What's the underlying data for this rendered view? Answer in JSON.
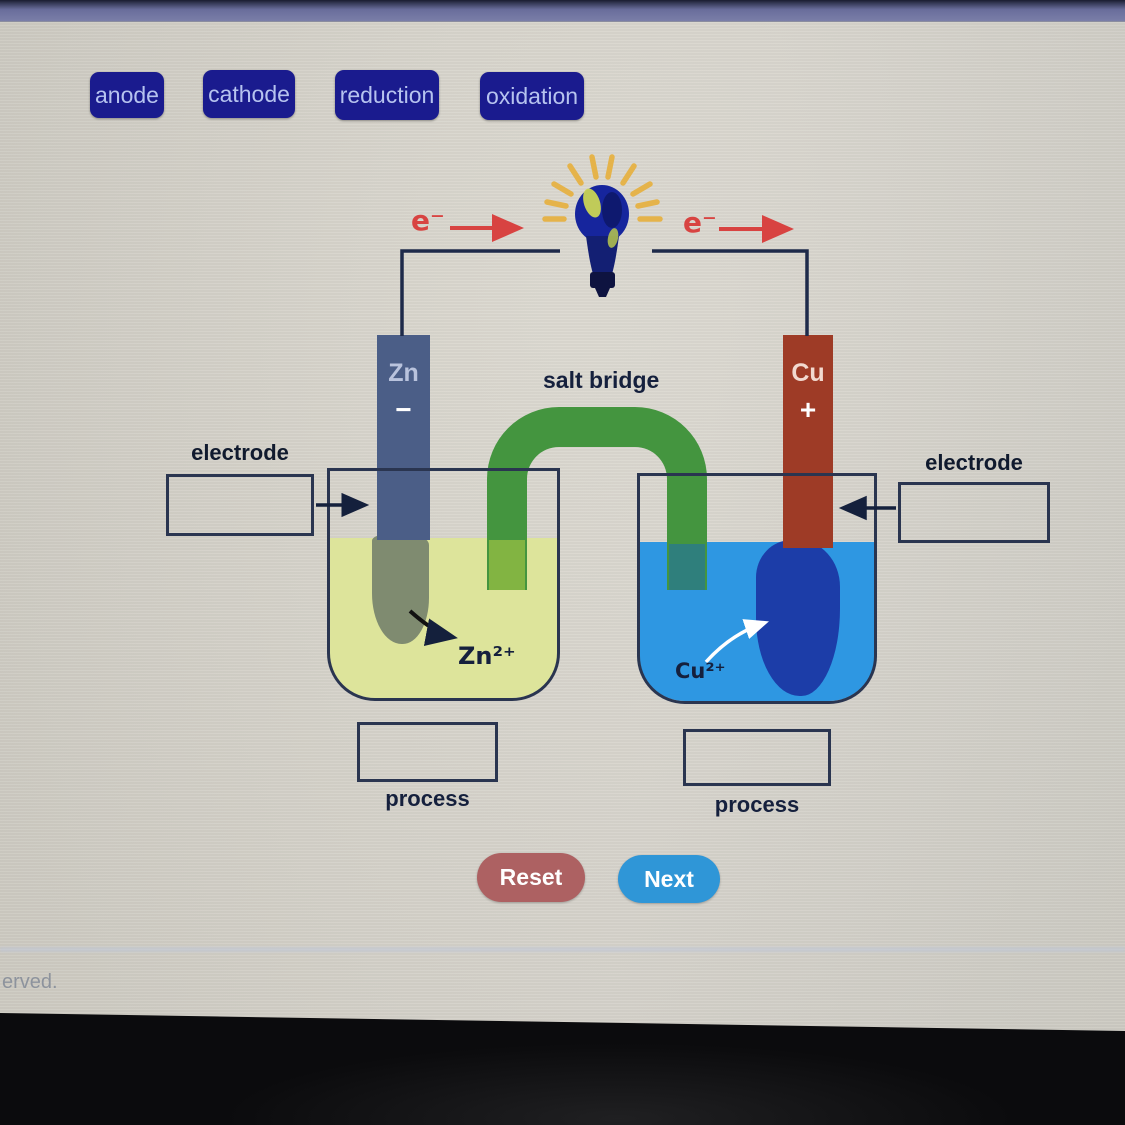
{
  "word_bank": {
    "anode": "anode",
    "cathode": "cathode",
    "reduction": "reduction",
    "oxidation": "oxidation"
  },
  "circuit": {
    "electron_label_left": "e⁻",
    "electron_label_right": "e⁻",
    "salt_bridge_label": "salt bridge"
  },
  "left_cell": {
    "electrode_symbol": "Zn",
    "electrode_charge": "−",
    "ion_label": "Zn²⁺",
    "drop_target_label": "electrode",
    "process_label": "process"
  },
  "right_cell": {
    "electrode_symbol": "Cu",
    "electrode_charge": "+",
    "ion_label": "Cu²⁺",
    "drop_target_label": "electrode",
    "process_label": "process"
  },
  "buttons": {
    "reset": "Reset",
    "next": "Next"
  },
  "footer": {
    "partial_text": "erved."
  },
  "colors": {
    "word_chip_bg": "#1a1b8e",
    "word_chip_text": "#b6c3ef",
    "salt_bridge_green": "#44953f",
    "zn_electrode": "#4b5e87",
    "cu_electrode": "#9e3b26",
    "zn_solution": "#dde49b",
    "cu_solution": "#2e97e2",
    "cu_deposit": "#1c3da8",
    "zn_corrosion": "#7f8b70",
    "electron_red": "#d84341",
    "wire_navy": "#1e2a4a",
    "reset_button": "#ad6162",
    "next_button": "#2f96d7",
    "top_bar": "#696d9b",
    "background": "#d9d6cd"
  }
}
